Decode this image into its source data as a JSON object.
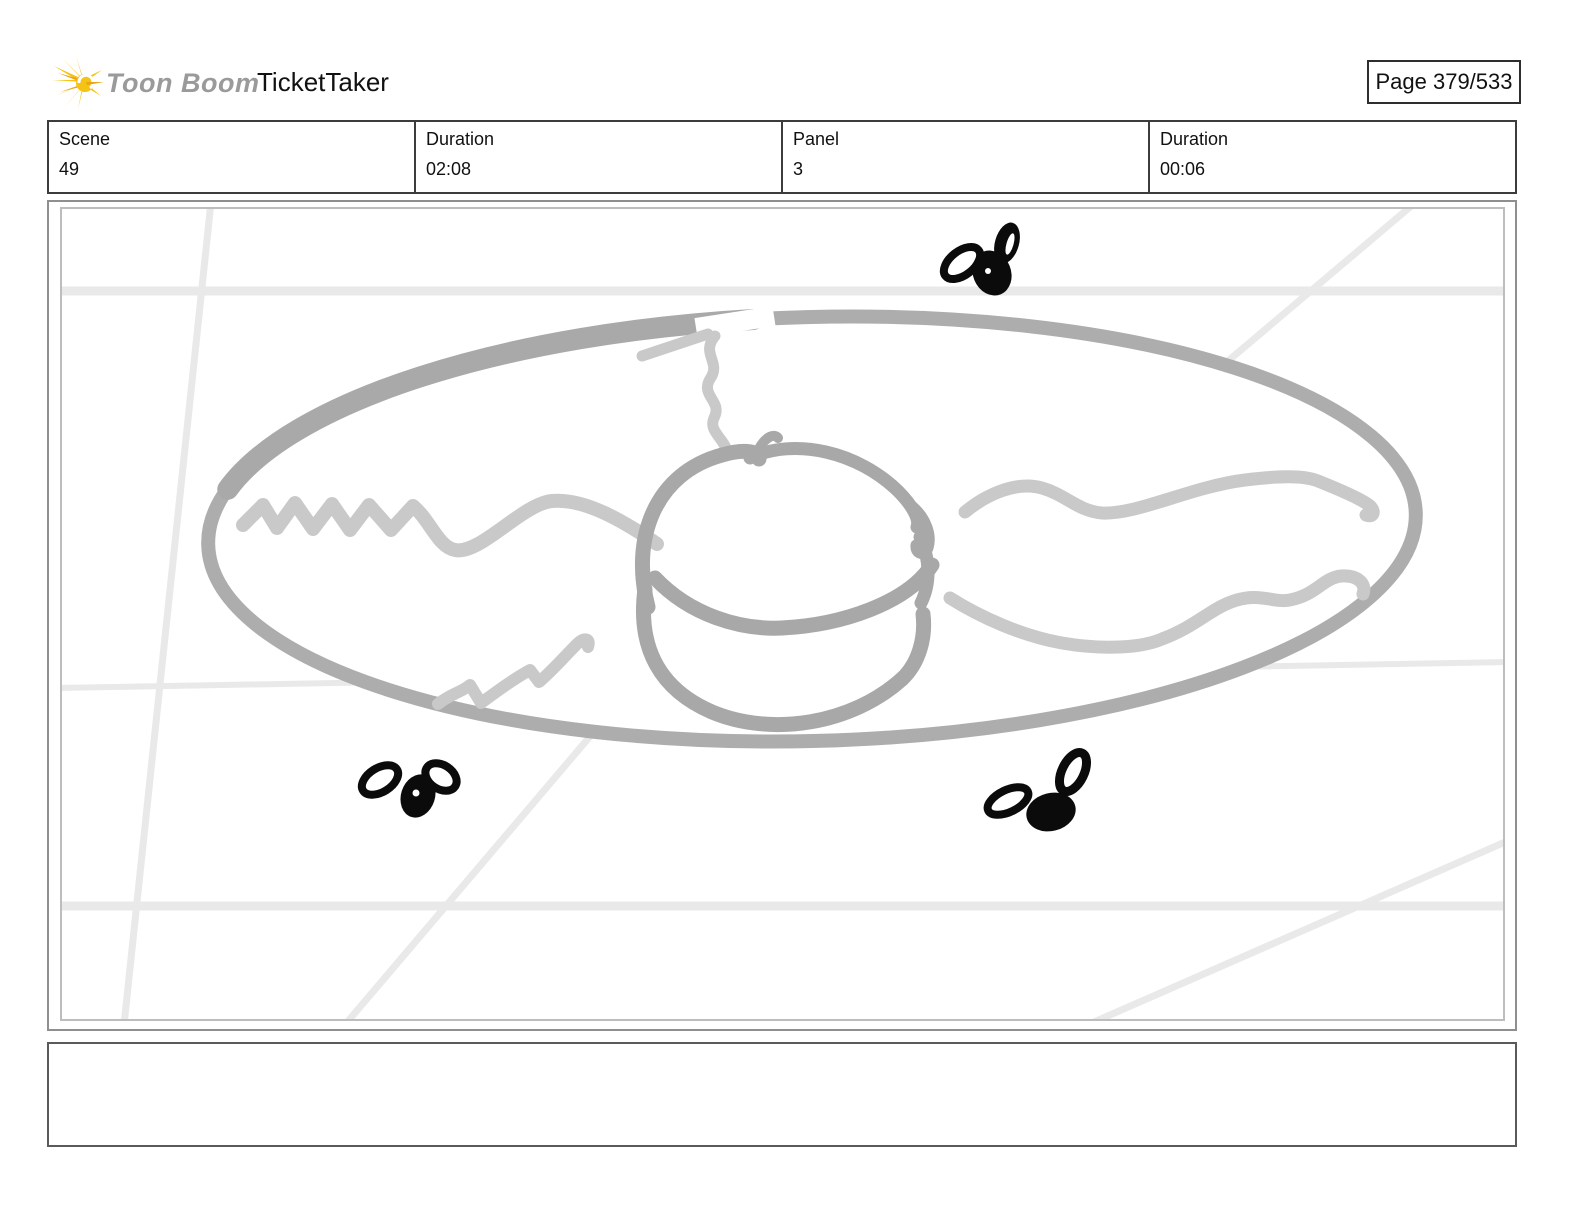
{
  "header": {
    "brand": "Toon Boom",
    "title": "TicketTaker",
    "page_label": "Page 379/533"
  },
  "info_table": {
    "cells": [
      {
        "label": "Scene",
        "value": "49"
      },
      {
        "label": "Duration",
        "value": "02:08"
      },
      {
        "label": "Panel",
        "value": "3"
      },
      {
        "label": "Duration",
        "value": "00:06"
      }
    ]
  },
  "panel": {
    "sketch_subject": "plate-with-center-bun-squiggles-and-three-flies",
    "icons": [
      "toonboom-starburst-logo-icon",
      "fly-icon",
      "fly-icon",
      "fly-icon"
    ]
  },
  "caption": {
    "text": ""
  },
  "colors": {
    "logo_yellow": "#F5C313",
    "logo_yellow_dark": "#E9A51A",
    "brand_gray": "#9A9A9A",
    "sketch_gray": "#ADADAD",
    "sketch_dark_gray": "#A8A8A8",
    "sketch_light_gray": "#C9C9C9",
    "guide_line_gray": "#E9E9E9",
    "fly_black": "#0B0B0B",
    "frame_gray": "#8F8F8F"
  }
}
